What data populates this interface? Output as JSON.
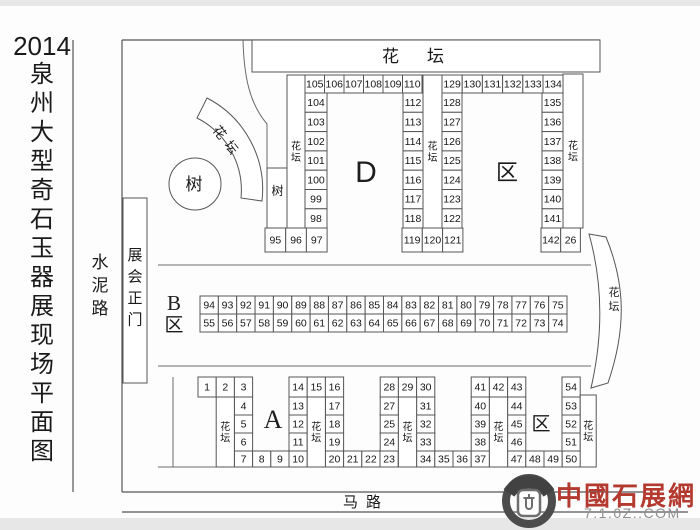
{
  "title": {
    "year": "2014",
    "text": "泉州大型奇石玉器展现场平面图"
  },
  "labels": {
    "left_road": "水泥路",
    "gate": "展会正门",
    "tree_circle": "树",
    "tree_booth": "树",
    "top_flowerbed": "花坛",
    "arc_flowerbed": "花坛",
    "right_flowerbed": "花坛",
    "bottom_road": "马路"
  },
  "areas": {
    "d": "D",
    "d_suffix": "区",
    "b": "B",
    "b_suffix": "区",
    "a": "A",
    "c_suffix": "区"
  },
  "watermark": {
    "name": "中國石展網",
    "url": "7.1.0Z..COM"
  },
  "map": {
    "groups": [
      {
        "name": "d-top-row-left",
        "type": "row",
        "x": 305,
        "y": 75,
        "w": 19.5,
        "h": 18,
        "labels": [
          "105",
          "106",
          "107",
          "108",
          "109",
          "110"
        ]
      },
      {
        "name": "d-col-104-98",
        "type": "col",
        "x": 305,
        "y": 93,
        "w": 22,
        "h": 19.3,
        "labels": [
          "104",
          "103",
          "102",
          "101",
          "100",
          "99",
          "98"
        ]
      },
      {
        "name": "d-col-112-118",
        "type": "col",
        "x": 403,
        "y": 93,
        "w": 20,
        "h": 19.3,
        "labels": [
          "112",
          "113",
          "114",
          "115",
          "116",
          "117",
          "118"
        ]
      },
      {
        "name": "d-row-95-97",
        "type": "row",
        "x": 265,
        "y": 228,
        "w": 20.7,
        "h": 24,
        "labels": [
          "95",
          "96",
          "97"
        ]
      },
      {
        "name": "d-row-119-121",
        "type": "row",
        "x": 402,
        "y": 228,
        "w": 20.3,
        "h": 24,
        "labels": [
          "119",
          "120",
          "121"
        ]
      },
      {
        "name": "d-col-128-122",
        "type": "col",
        "x": 442,
        "y": 93,
        "w": 20,
        "h": 19.3,
        "labels": [
          "128",
          "127",
          "126",
          "125",
          "124",
          "123",
          "122"
        ]
      },
      {
        "name": "d-top-row-right",
        "type": "row",
        "x": 442,
        "y": 75,
        "w": 20.2,
        "h": 18,
        "labels": [
          "129",
          "130",
          "131",
          "132",
          "133",
          "134"
        ]
      },
      {
        "name": "d-col-135-141",
        "type": "col",
        "x": 542,
        "y": 93,
        "w": 21,
        "h": 19.3,
        "labels": [
          "135",
          "136",
          "137",
          "138",
          "139",
          "140",
          "141"
        ]
      },
      {
        "name": "d-row-142-26",
        "type": "row",
        "x": 541,
        "y": 228,
        "w": 19.7,
        "h": 24,
        "labels": [
          "142",
          "26"
        ]
      },
      {
        "name": "b-row-top",
        "type": "row",
        "x": 200,
        "y": 296,
        "w": 18.35,
        "h": 18,
        "labels": [
          "94",
          "93",
          "92",
          "91",
          "90",
          "89",
          "88",
          "87",
          "86",
          "85",
          "84",
          "83",
          "82",
          "81",
          "80",
          "79",
          "78",
          "77",
          "76",
          "75"
        ]
      },
      {
        "name": "b-row-bottom",
        "type": "row",
        "x": 200,
        "y": 314,
        "w": 18.35,
        "h": 18,
        "labels": [
          "55",
          "56",
          "57",
          "58",
          "59",
          "60",
          "61",
          "62",
          "63",
          "64",
          "65",
          "66",
          "67",
          "68",
          "69",
          "70",
          "71",
          "72",
          "73",
          "74"
        ]
      },
      {
        "name": "a1-top",
        "type": "row",
        "x": 198,
        "y": 377,
        "w": 18.2,
        "h": 20,
        "labels": [
          "1",
          "2",
          "3"
        ]
      },
      {
        "name": "a1-col",
        "type": "col",
        "x": 234.4,
        "y": 397,
        "w": 18.2,
        "h": 18,
        "labels": [
          "4",
          "5",
          "6"
        ]
      },
      {
        "name": "a1-bottom",
        "type": "row",
        "x": 234.4,
        "y": 451,
        "w": 18.2,
        "h": 16,
        "labels": [
          "7",
          "8",
          "9",
          "10"
        ]
      },
      {
        "name": "a2-top",
        "type": "row",
        "x": 289,
        "y": 377,
        "w": 18.2,
        "h": 20,
        "labels": [
          "14",
          "15",
          "16"
        ]
      },
      {
        "name": "a2-col-left",
        "type": "col",
        "x": 289,
        "y": 397,
        "w": 18.2,
        "h": 18,
        "labels": [
          "13",
          "12",
          "11"
        ]
      },
      {
        "name": "a2-col-right",
        "type": "col",
        "x": 325.4,
        "y": 397,
        "w": 18.2,
        "h": 18,
        "labels": [
          "17",
          "18",
          "19"
        ]
      },
      {
        "name": "a2-bottom",
        "type": "row",
        "x": 325.4,
        "y": 451,
        "w": 18.2,
        "h": 16,
        "labels": [
          "20",
          "21",
          "22",
          "23"
        ]
      },
      {
        "name": "a3-top",
        "type": "row",
        "x": 380.2,
        "y": 377,
        "w": 18.2,
        "h": 20,
        "labels": [
          "28",
          "29",
          "30"
        ]
      },
      {
        "name": "a3-col-left",
        "type": "col",
        "x": 380.2,
        "y": 397,
        "w": 18.2,
        "h": 18,
        "labels": [
          "27",
          "25",
          "24"
        ]
      },
      {
        "name": "a3-col-right",
        "type": "col",
        "x": 416.6,
        "y": 397,
        "w": 18.2,
        "h": 18,
        "labels": [
          "31",
          "32",
          "33"
        ]
      },
      {
        "name": "a3-bottom",
        "type": "row",
        "x": 416.6,
        "y": 451,
        "w": 18.2,
        "h": 16,
        "labels": [
          "34",
          "35",
          "36",
          "37"
        ]
      },
      {
        "name": "c1-top",
        "type": "row",
        "x": 471.2,
        "y": 377,
        "w": 18.2,
        "h": 20,
        "labels": [
          "41",
          "42",
          "43"
        ]
      },
      {
        "name": "c1-col-left",
        "type": "col",
        "x": 471.2,
        "y": 397,
        "w": 18.2,
        "h": 18,
        "labels": [
          "40",
          "39",
          "38"
        ]
      },
      {
        "name": "c1-col-right",
        "type": "col",
        "x": 507.6,
        "y": 397,
        "w": 18.2,
        "h": 18,
        "labels": [
          "44",
          "45",
          "46"
        ]
      },
      {
        "name": "c1-bottom",
        "type": "row",
        "x": 507.6,
        "y": 451,
        "w": 18.2,
        "h": 16,
        "labels": [
          "47",
          "48",
          "49",
          "50"
        ]
      },
      {
        "name": "c2-top",
        "type": "row",
        "x": 562,
        "y": 377,
        "w": 18.2,
        "h": 20,
        "labels": [
          "54"
        ]
      },
      {
        "name": "c2-col",
        "type": "col",
        "x": 562,
        "y": 397,
        "w": 18.2,
        "h": 18,
        "labels": [
          "53",
          "52",
          "51"
        ]
      }
    ],
    "flowerbeds": [
      {
        "x": 287,
        "y": 75,
        "w": 18,
        "h": 153,
        "label": "花坛"
      },
      {
        "x": 423,
        "y": 75,
        "w": 19,
        "h": 153,
        "label": "花坛"
      },
      {
        "x": 563,
        "y": 74,
        "w": 20,
        "h": 154,
        "label": "花坛"
      },
      {
        "x": 216.2,
        "y": 397,
        "w": 18.2,
        "h": 70,
        "label": "花坛"
      },
      {
        "x": 307.2,
        "y": 397,
        "w": 18.2,
        "h": 70,
        "label": "花坛"
      },
      {
        "x": 398.4,
        "y": 397,
        "w": 18.2,
        "h": 70,
        "label": "花坛"
      },
      {
        "x": 489.4,
        "y": 397,
        "w": 18.2,
        "h": 70,
        "label": "花坛"
      },
      {
        "x": 580.2,
        "y": 395,
        "w": 16,
        "h": 72,
        "label": "花坛"
      }
    ]
  }
}
